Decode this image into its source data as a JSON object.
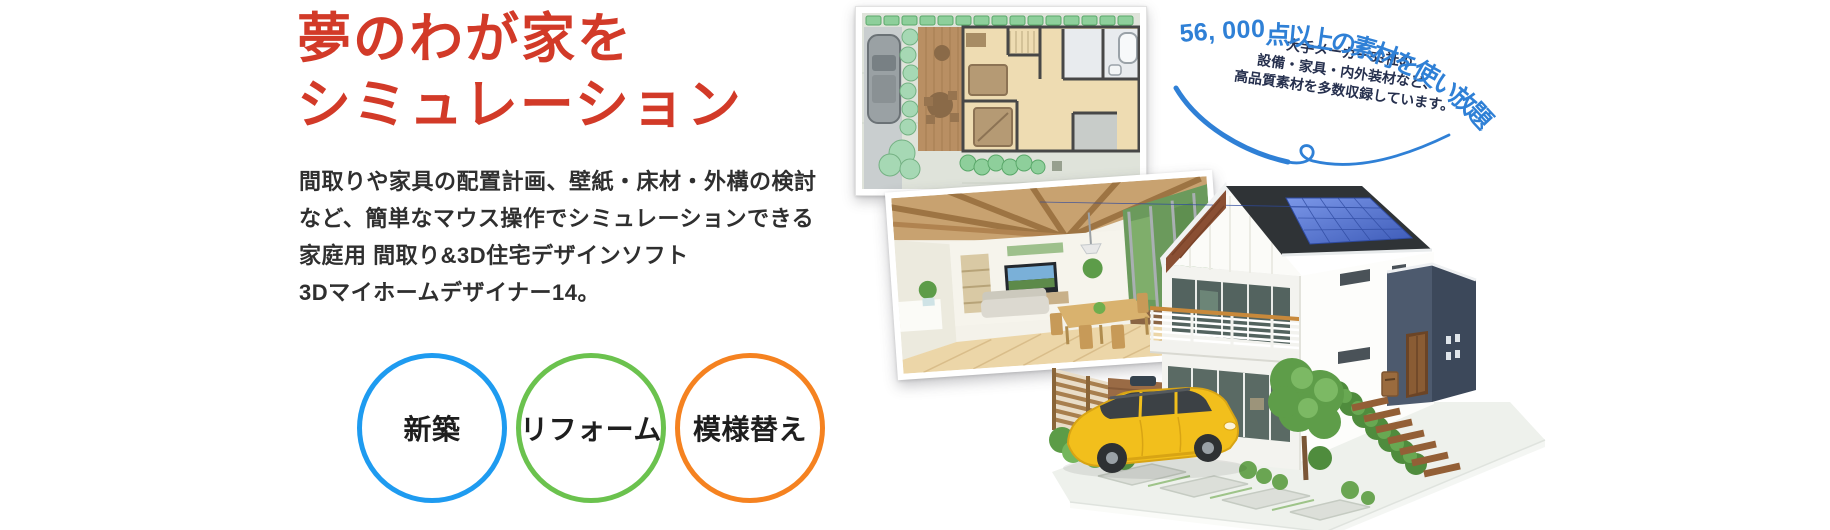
{
  "page": {
    "background": "#ffffff"
  },
  "hero": {
    "heading": {
      "line1": "夢のわが家を",
      "line2": "シミュレーション",
      "color": "#d23a28"
    },
    "description": [
      "間取りや家具の配置計画、壁紙・床材・外構の検討",
      "など、簡単なマウス操作でシミュレーションできる",
      "家庭用 間取り&3D住宅デザインソフト",
      "3Dマイホームデザイナー14。"
    ],
    "badges": [
      {
        "label": "新築",
        "color": "#1e9bf0"
      },
      {
        "label": "リフォーム",
        "color": "#6bc24e"
      },
      {
        "label": "模様替え",
        "color": "#f58220"
      }
    ]
  },
  "callout": {
    "arc_text": "56,000点以上の素材を使い放題",
    "arc_color": "#2f80d6",
    "lines": [
      "大手メーカー53社の",
      "設備・家具・内外装材など、",
      "高品質素材を多数収録しています。"
    ],
    "lines_color": "#26304e",
    "swoosh_color": "#2f80d6"
  },
  "illustrations": {
    "floorplan": "2d-floorplan-thumbnail",
    "interior": "3d-interior-render-thumbnail",
    "house": "3d-house-exterior-render"
  }
}
